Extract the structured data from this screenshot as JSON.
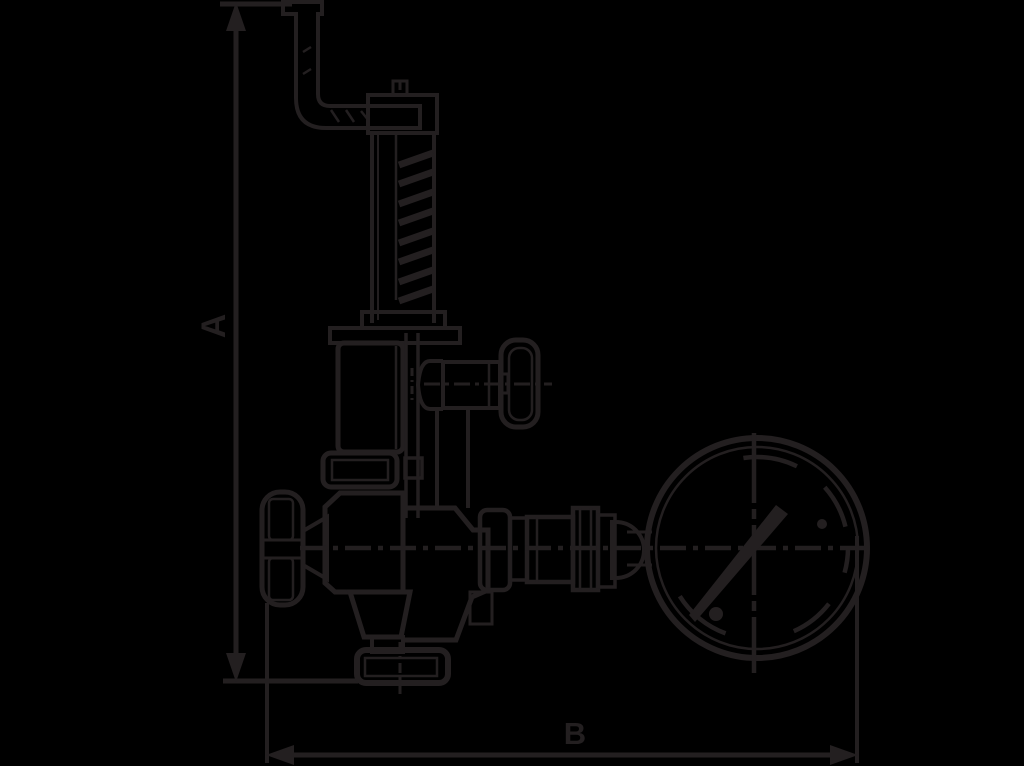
{
  "drawing": {
    "type": "technical-dimension-drawing",
    "subject": "safety relief valve with test lever, handwheels and pressure gauge",
    "background_color": "#000000",
    "line_color": "#231f20",
    "dimensions": {
      "a_label": "A",
      "b_label": "B"
    },
    "parts": [
      "test-lever",
      "spring-housing",
      "bonnet",
      "side-outlet-handwheel",
      "left-handwheel",
      "valve-body",
      "bottom-flange",
      "union-fitting",
      "pressure-gauge"
    ]
  }
}
